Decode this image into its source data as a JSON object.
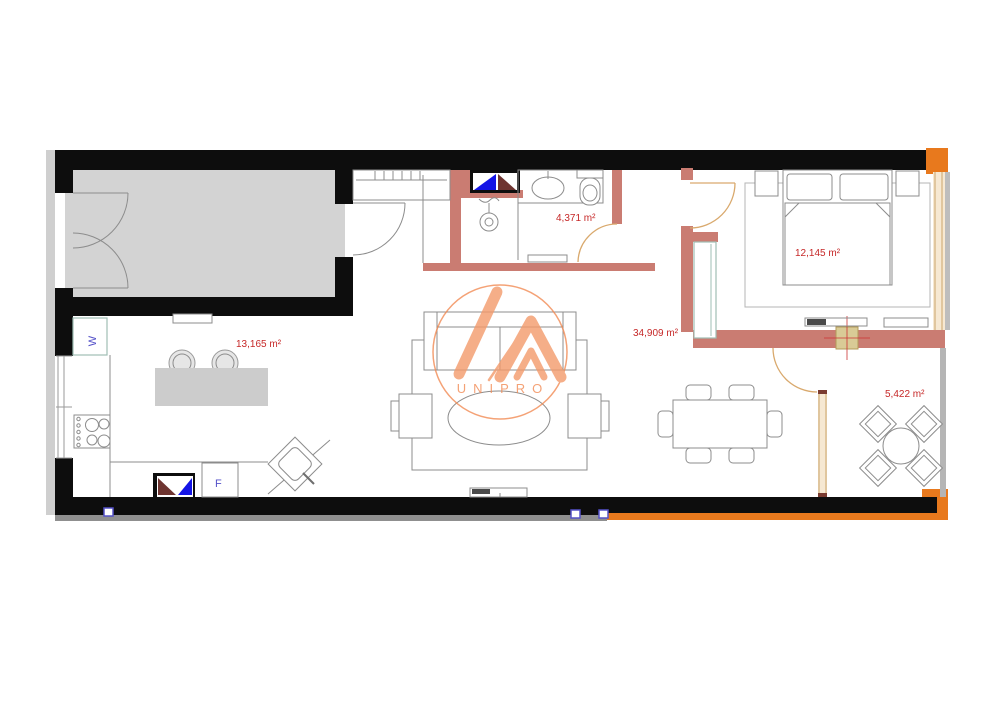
{
  "plan": {
    "title": "apartment-floor-plan",
    "watermark": {
      "brand_text": "UNIPRO"
    },
    "room_labels": {
      "kitchen": "13,165 m²",
      "bathroom": "4,371 m²",
      "living": "34,909 m²",
      "bedroom": "12,145 m²",
      "terrace": "5,422 m²"
    },
    "appliance_labels": {
      "washer": "W",
      "fridge": "F"
    },
    "colors": {
      "wall_black": "#0d0d0d",
      "partition_pink": "#ca7c72",
      "accent_orange": "#e8791d",
      "column_tan": "#d9cb96",
      "door_arc_tan": "#d9a96d",
      "window_cream": "#f6e8d2",
      "label_red": "#c62828",
      "appliance_blue": "#5552c9",
      "garage_gray": "#d3d3d3",
      "watermark_orange": "#f28b55",
      "marker_blue": "#5552c9",
      "triangle_blue": "#1414e6",
      "triangle_maroon": "#6e3430"
    }
  }
}
